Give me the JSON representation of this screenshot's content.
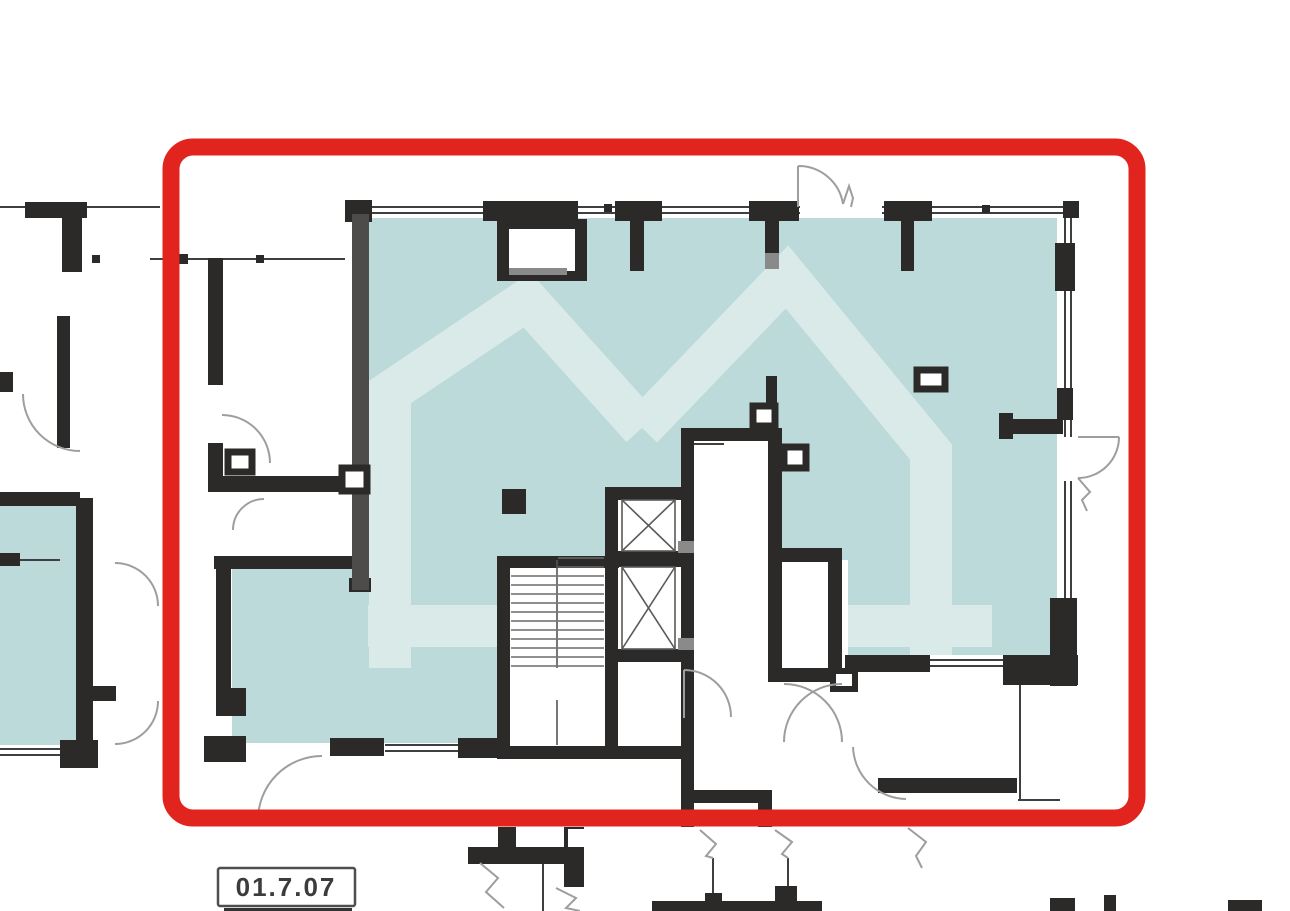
{
  "plan": {
    "unit_label": "01.7.07",
    "highlight_frame_color": "#e2241e",
    "unit_fill_color": "#bcdad9",
    "neighbor_fill_color": "#bcdad9",
    "watermark_color": "#d9eae9",
    "wall_color": "#2b2a28",
    "partition_gray": "#4e4c4a",
    "thin_line_color": "#3f3f3f",
    "core_line_color": "#5a5a5a",
    "arc_color": "#9e9e9e",
    "shade_gray": "#8a8a8a",
    "label_text_color": "#3c3c3c",
    "label_border_color": "#4e4e4e"
  }
}
